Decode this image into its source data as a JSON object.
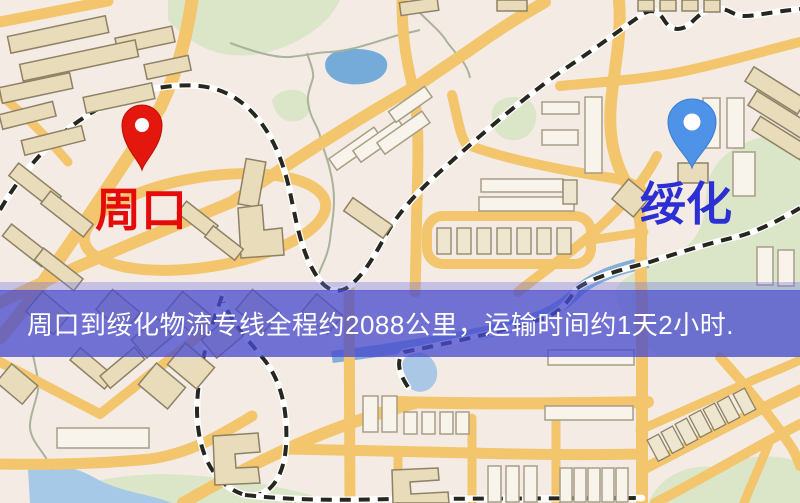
{
  "map": {
    "origin": {
      "label": "周口"
    },
    "destination": {
      "label": "绥化"
    }
  },
  "banner": {
    "text": "周口到绥化物流专线全程约2088公里，运输时间约1天2小时."
  },
  "colors": {
    "origin_pin": "#e3170d",
    "origin_label": "#e60b0b",
    "destination_pin": "#4f93e8",
    "destination_label": "#2b2fd4",
    "banner_bg": "rgba(73,75,205,0.77)",
    "banner_text": "#ffffff",
    "road": "#f3c56d",
    "water": "#74abd8",
    "park": "#dbe6c9"
  }
}
